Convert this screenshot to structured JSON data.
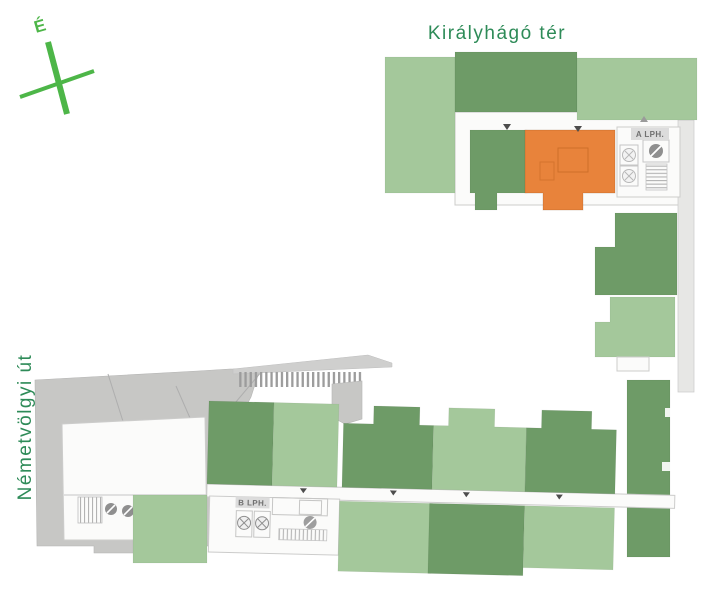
{
  "labels": {
    "street_top": "Királyhágó tér",
    "street_left": "Németvölgyi út",
    "compass_north": "É",
    "staircase_a": "A LPH.",
    "staircase_b": "B LPH."
  },
  "colors": {
    "available-light": "#A4C89B",
    "available-dark": "#6E9B67",
    "selected": "#E8833B",
    "street-label": "#2E8B58",
    "compass": "#4DB648",
    "gray-building": "#C7C7C5",
    "floor": "#FBFBFA",
    "outline": "#CCCCCB",
    "label-box": "#DCDCDC",
    "label-text": "#707070",
    "slat": "#9C9C9C",
    "mark": "#4D4D4D",
    "walkway": "#E7E7E5"
  }
}
